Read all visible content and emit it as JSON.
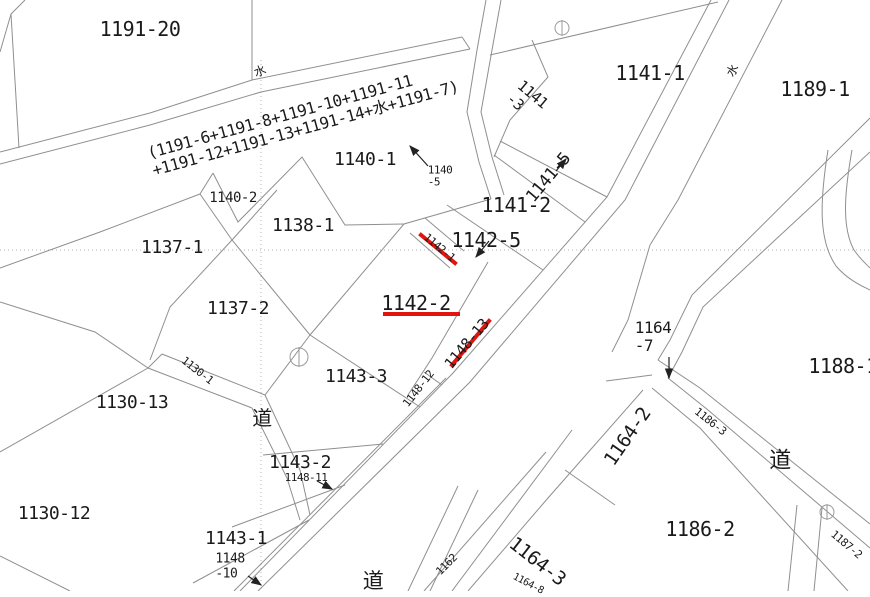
{
  "colors": {
    "background": "#ffffff",
    "parcel_line": "#8f8f8f",
    "text": "#1a1a1a",
    "highlight_red": "#e0150f",
    "grid_dotted": "#b5b5b5",
    "arrow": "#222222"
  },
  "map": {
    "type": "cadastral-parcel-map",
    "road_kanji": "道",
    "water_kanji": "水",
    "highlights": [
      {
        "parcel": "1142-1",
        "type": "red-line"
      },
      {
        "parcel": "1142-2",
        "type": "red-underline"
      },
      {
        "parcel": "1148-13",
        "type": "red-underline"
      }
    ],
    "labels": [
      {
        "name": "parcel-label-1191-20",
        "text": "1191-20",
        "x": 140,
        "y": 29,
        "rot": 0,
        "size": 20
      },
      {
        "name": "merged-parcel-group-label",
        "text": "(1191-6+1191-8+1191-10+1191-11\n+1191-12+1191-13+1191-14+水+1191-7)",
        "x": 303,
        "y": 120,
        "rot": -15.5,
        "size": 16
      },
      {
        "name": "parcel-label-1140-1",
        "text": "1140-1",
        "x": 365,
        "y": 160,
        "rot": 0,
        "size": 18
      },
      {
        "name": "parcel-label-1140-2",
        "text": "1140-2",
        "x": 233,
        "y": 199,
        "rot": 0,
        "size": 14
      },
      {
        "name": "parcel-label-1140-5",
        "text": "1140\n-5",
        "x": 440,
        "y": 177,
        "rot": 0,
        "size": 11
      },
      {
        "name": "parcel-label-1138-1",
        "text": "1138-1",
        "x": 303,
        "y": 226,
        "rot": 0,
        "size": 18
      },
      {
        "name": "parcel-label-1137-1",
        "text": "1137-1",
        "x": 172,
        "y": 248,
        "rot": 0,
        "size": 18
      },
      {
        "name": "parcel-label-1137-2",
        "text": "1137-2",
        "x": 238,
        "y": 309,
        "rot": 0,
        "size": 18
      },
      {
        "name": "parcel-label-1130-13",
        "text": "1130-13",
        "x": 132,
        "y": 403,
        "rot": 0,
        "size": 18
      },
      {
        "name": "parcel-label-1130-12",
        "text": "1130-12",
        "x": 54,
        "y": 514,
        "rot": 0,
        "size": 18
      },
      {
        "name": "parcel-label-1130-1",
        "text": "1130-1",
        "x": 197,
        "y": 371,
        "rot": 38,
        "size": 11
      },
      {
        "name": "parcel-label-1143-3",
        "text": "1143-3",
        "x": 356,
        "y": 377,
        "rot": 0,
        "size": 18
      },
      {
        "name": "parcel-label-1143-2",
        "text": "1143-2",
        "x": 300,
        "y": 463,
        "rot": 0,
        "size": 18
      },
      {
        "name": "parcel-label-1143-1",
        "text": "1143-1",
        "x": 236,
        "y": 539,
        "rot": 0,
        "size": 18
      },
      {
        "name": "parcel-label-1148-10",
        "text": "1148\n-10",
        "x": 230,
        "y": 567,
        "rot": 0,
        "size": 13
      },
      {
        "name": "parcel-label-1148-11",
        "text": "1148-11",
        "x": 306,
        "y": 478,
        "rot": 0,
        "size": 11
      },
      {
        "name": "parcel-label-1148-12",
        "text": "1148-12",
        "x": 419,
        "y": 389,
        "rot": -52,
        "size": 11
      },
      {
        "name": "parcel-label-1148-13",
        "text": "1148-13",
        "x": 467,
        "y": 344,
        "rot": -50,
        "size": 15
      },
      {
        "name": "parcel-label-1142-2",
        "text": "1142-2",
        "x": 416,
        "y": 303,
        "rot": 0,
        "size": 20
      },
      {
        "name": "parcel-label-1142-1",
        "text": "1142-1",
        "x": 439,
        "y": 248,
        "rot": 40,
        "size": 11
      },
      {
        "name": "parcel-label-1142-5",
        "text": "1142-5",
        "x": 486,
        "y": 240,
        "rot": 0,
        "size": 20
      },
      {
        "name": "parcel-label-1141-2",
        "text": "1141-2",
        "x": 516,
        "y": 205,
        "rot": 0,
        "size": 20
      },
      {
        "name": "parcel-label-1141-5",
        "text": "1141-5",
        "x": 549,
        "y": 178,
        "rot": -50,
        "size": 17
      },
      {
        "name": "parcel-label-1141-3",
        "text": "1141\n-3",
        "x": 527,
        "y": 101,
        "rot": 40,
        "size": 15
      },
      {
        "name": "parcel-label-1141-1",
        "text": "1141-1",
        "x": 650,
        "y": 73,
        "rot": 0,
        "size": 20
      },
      {
        "name": "parcel-label-1189-1",
        "text": "1189-1",
        "x": 815,
        "y": 89,
        "rot": 0,
        "size": 20
      },
      {
        "name": "parcel-label-1164-7",
        "text": "1164\n-7",
        "x": 653,
        "y": 337,
        "rot": 0,
        "size": 16
      },
      {
        "name": "parcel-label-1164-2",
        "text": "1164-2",
        "x": 628,
        "y": 437,
        "rot": -55,
        "size": 19
      },
      {
        "name": "parcel-label-1186-3",
        "text": "1186-3",
        "x": 710,
        "y": 422,
        "rot": 38,
        "size": 11
      },
      {
        "name": "parcel-label-1188-1",
        "text": "1188-1",
        "x": 843,
        "y": 366,
        "rot": 0,
        "size": 20
      },
      {
        "name": "parcel-label-1186-2",
        "text": "1186-2",
        "x": 700,
        "y": 529,
        "rot": 0,
        "size": 20
      },
      {
        "name": "parcel-label-1164-3",
        "text": "1164-3",
        "x": 537,
        "y": 562,
        "rot": 38,
        "size": 19
      },
      {
        "name": "parcel-label-1164-8",
        "text": "1164-8",
        "x": 528,
        "y": 584,
        "rot": 28,
        "size": 10
      },
      {
        "name": "parcel-label-1162",
        "text": "1162",
        "x": 447,
        "y": 565,
        "rot": -45,
        "size": 11
      },
      {
        "name": "road-kanji-label-west",
        "text": "道",
        "x": 262,
        "y": 418,
        "rot": 0,
        "size": 20
      },
      {
        "name": "road-kanji-label-south",
        "text": "道",
        "x": 373,
        "y": 582,
        "rot": 0,
        "size": 21
      },
      {
        "name": "road-kanji-label-east",
        "text": "道",
        "x": 780,
        "y": 462,
        "rot": 0,
        "size": 22
      },
      {
        "name": "water-kanji-label-west",
        "text": "水",
        "x": 260,
        "y": 72,
        "rot": -20,
        "size": 12
      },
      {
        "name": "water-kanji-label-east",
        "text": "水",
        "x": 733,
        "y": 71,
        "rot": -60,
        "size": 12
      },
      {
        "name": "parcel-label-1187-2",
        "text": "1187-2",
        "x": 846,
        "y": 545,
        "rot": 40,
        "size": 11
      }
    ]
  }
}
